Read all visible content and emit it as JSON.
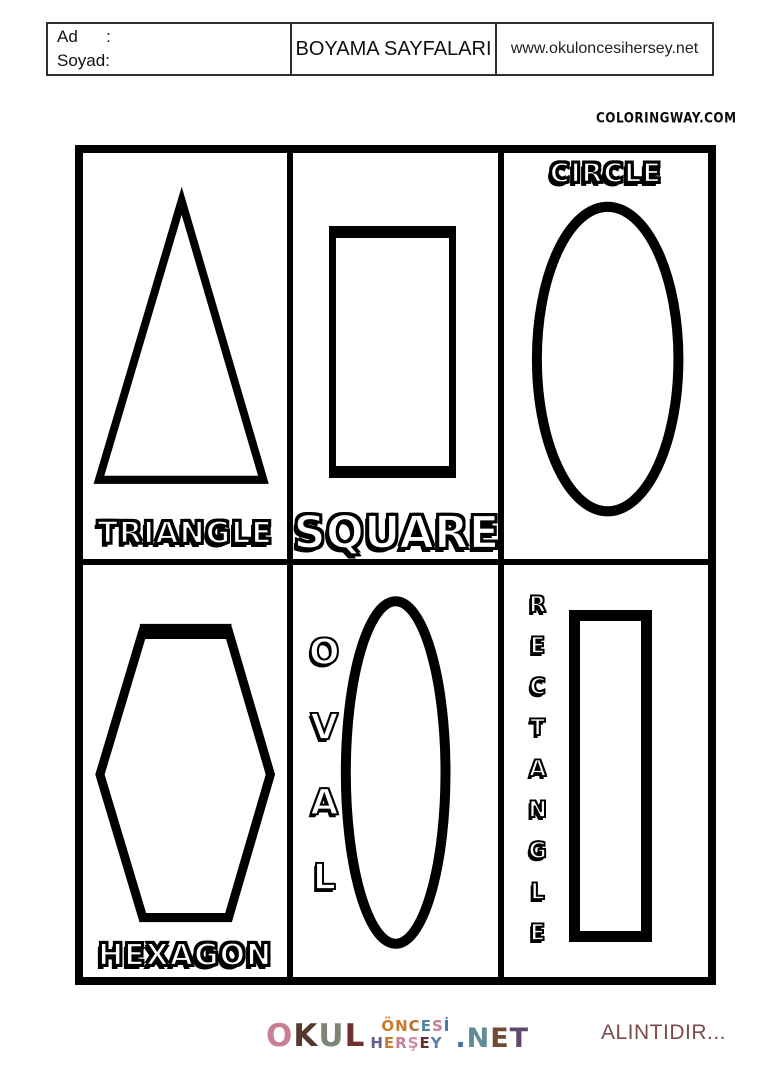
{
  "header": {
    "name_label": "Ad      :",
    "surname_label": "Soyad:",
    "title": "BOYAMA SAYFALARI",
    "website": "www.okuloncesihersey.net"
  },
  "watermark": "COLORINGWAY.COM",
  "cells": {
    "triangle": {
      "label": "TRIANGLE"
    },
    "square": {
      "label": "SQUARE"
    },
    "circle": {
      "label": "CIRCLE"
    },
    "hexagon": {
      "label": "HEXAGON"
    },
    "oval": {
      "label": "OVAL"
    },
    "rectangle": {
      "label": "RECTANGLE"
    }
  },
  "footer": {
    "attribution": "ALINTIDIR...",
    "attribution_color": "#7d4a4a",
    "logo": {
      "okul": [
        {
          "char": "O",
          "color": "#c97f93"
        },
        {
          "char": "K",
          "color": "#53392e"
        },
        {
          "char": "U",
          "color": "#7d8574"
        },
        {
          "char": "L",
          "color": "#6e2f2f"
        }
      ],
      "oncesi": [
        {
          "char": "Ö",
          "color": "#c87a2e"
        },
        {
          "char": "N",
          "color": "#c87a2e"
        },
        {
          "char": "C",
          "color": "#b96f2a"
        },
        {
          "char": "E",
          "color": "#4d86a0"
        },
        {
          "char": "S",
          "color": "#c97f93"
        },
        {
          "char": "İ",
          "color": "#4a6fa5"
        }
      ],
      "hersey": [
        {
          "char": "H",
          "color": "#6a5b96"
        },
        {
          "char": "E",
          "color": "#c87a2e"
        },
        {
          "char": "R",
          "color": "#c97f93"
        },
        {
          "char": "Ş",
          "color": "#d28ba0"
        },
        {
          "char": "E",
          "color": "#5e2e2e"
        },
        {
          "char": "Y",
          "color": "#5b80a8"
        }
      ],
      "net": [
        {
          "char": ".",
          "color": "#4a6fa5"
        },
        {
          "char": "N",
          "color": "#5f8d96"
        },
        {
          "char": "E",
          "color": "#6e4b35"
        },
        {
          "char": "T",
          "color": "#5c4a6e"
        }
      ]
    }
  },
  "colors": {
    "ink": "#000000"
  }
}
